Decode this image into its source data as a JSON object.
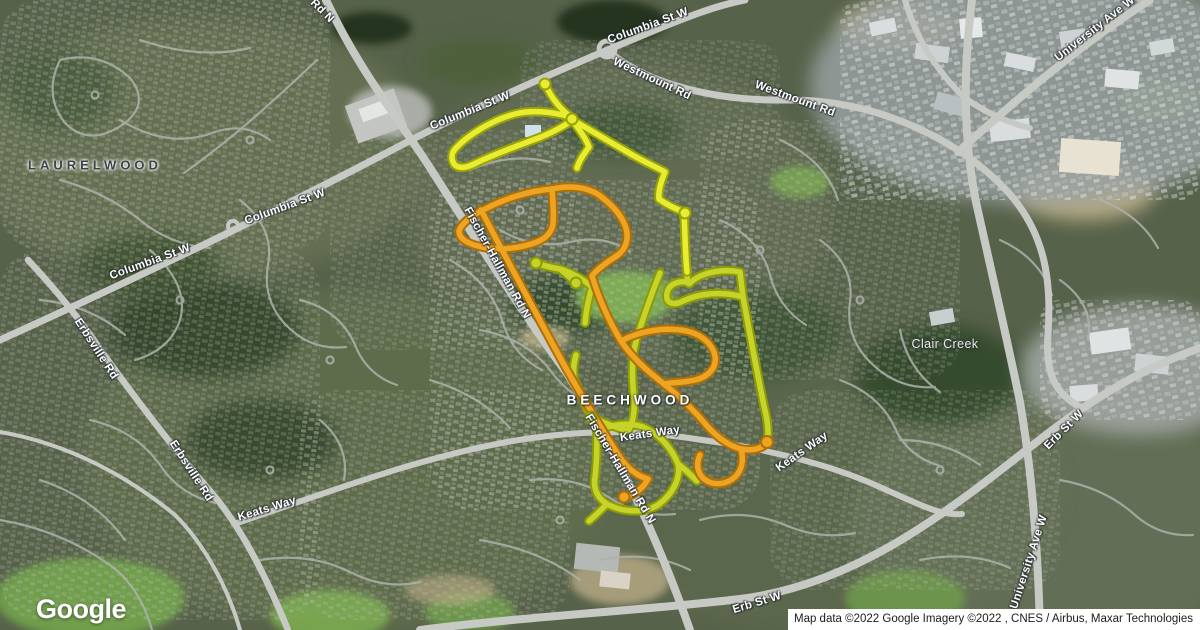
{
  "branding": {
    "logo_text": "Google"
  },
  "attribution": {
    "text": "Map data ©2022 Google Imagery ©2022 , CNES / Airbus, Maxar Technologies"
  },
  "map": {
    "view_type": "satellite",
    "place_labels": [
      {
        "text": "LAURELWOOD"
      },
      {
        "text": "BEECHWOOD"
      },
      {
        "text": "Clair Creek"
      }
    ],
    "road_labels": [
      {
        "text": "Rd N"
      },
      {
        "text": "Columbia St W"
      },
      {
        "text": "Westmount Rd"
      },
      {
        "text": "Westmount Rd"
      },
      {
        "text": "Columbia St W"
      },
      {
        "text": "Columbia St W"
      },
      {
        "text": "Columbia St W"
      },
      {
        "text": "University Ave W"
      },
      {
        "text": "Erbsville Rd"
      },
      {
        "text": "Erbsville Rd"
      },
      {
        "text": "Keats Way"
      },
      {
        "text": "Keats Way"
      },
      {
        "text": "Keats Way"
      },
      {
        "text": "Fischer-Hallman Rd N"
      },
      {
        "text": "Fischer-Hallman Rd N"
      },
      {
        "text": "Erb St W"
      },
      {
        "text": "Erb St W"
      },
      {
        "text": "University Ave W"
      }
    ],
    "route_overlay": {
      "colors": {
        "yellow": "#e8ed33",
        "yellow_green": "#c5d32a",
        "orange": "#eca424"
      }
    }
  }
}
